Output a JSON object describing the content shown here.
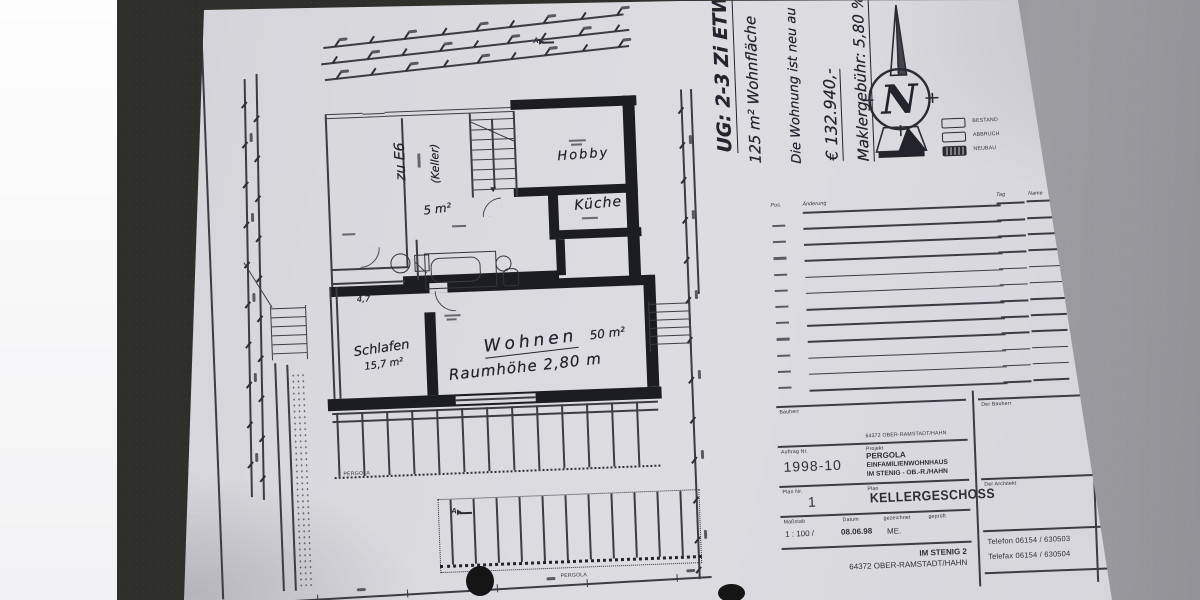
{
  "handwritten_notes": {
    "line1": "UG: 2-3 Zi ETW",
    "line2": "125 m² Wohnfläche",
    "line3": "Die Wohnung ist neu au",
    "line4": "€ 132.940,-",
    "line5": "Maklergebühr: 5,80 %"
  },
  "compass": {
    "letter": "N"
  },
  "legend": {
    "bestand": "BESTAND",
    "abbruch": "ABBRUCH",
    "neubau": "NEUBAU"
  },
  "revision_table": {
    "col_pos": "Pos.",
    "col_change": "Änderung",
    "col_day": "Tag",
    "col_name": "Name",
    "row_count": 11
  },
  "plan_labels": {
    "zu_e6": "zu E6",
    "keller": "(Keller)",
    "hobby": "Hobby",
    "kueche": "Küche",
    "area_5": "5 m²",
    "schlafen": "Schlafen",
    "schlafen_area": "15,7 m²",
    "wohnen": "Wohnen",
    "wohnen_area": "50 m²",
    "raumhoehe": "Raumhöhe 2,80 m",
    "dim_47": "4,7",
    "pergola_upper": "PERGOLA",
    "pergola_lower": "PERGOLA",
    "section_mark": "A"
  },
  "title_block": {
    "bauherr_label": "Bauherr",
    "ort": "64372 OBER-RAMSTADT/HAHN",
    "auftrag_label": "Auftrag Nr.",
    "auftrag_nr": "1998-10",
    "projekt_label": "Projekt",
    "projekt_name": "PERGOLA",
    "projekt_art": "EINFAMILIENWOHNHAUS",
    "projekt_ort": "IM STENIG - OB.-R./HAHN",
    "plan_nr_label": "Plan Nr.",
    "plan_nr": "1",
    "plan_label": "Plan",
    "plan_name": "KELLERGESCHOSS",
    "massstab_label": "Maßstab",
    "massstab": "1 : 100  /",
    "datum_label": "Datum",
    "datum": "08.06.98",
    "gezeichnet_label": "gezeichnet",
    "gezeichnet": "ME.",
    "geprueft_label": "geprüft",
    "firma_zeile1": "IM STENIG 2",
    "firma_zeile2": "64372 OBER-RAMSTADT/HAHN",
    "der_bauherr": "Der Bauherr",
    "der_architekt": "Der Architekt",
    "telefon": "Telefon   06154 / 630503",
    "telefax": "Telefax   06154 / 630504"
  },
  "colors": {
    "paper": "#d7d7dc",
    "ink": "#2a2a33",
    "table_dark": "#30302c"
  }
}
